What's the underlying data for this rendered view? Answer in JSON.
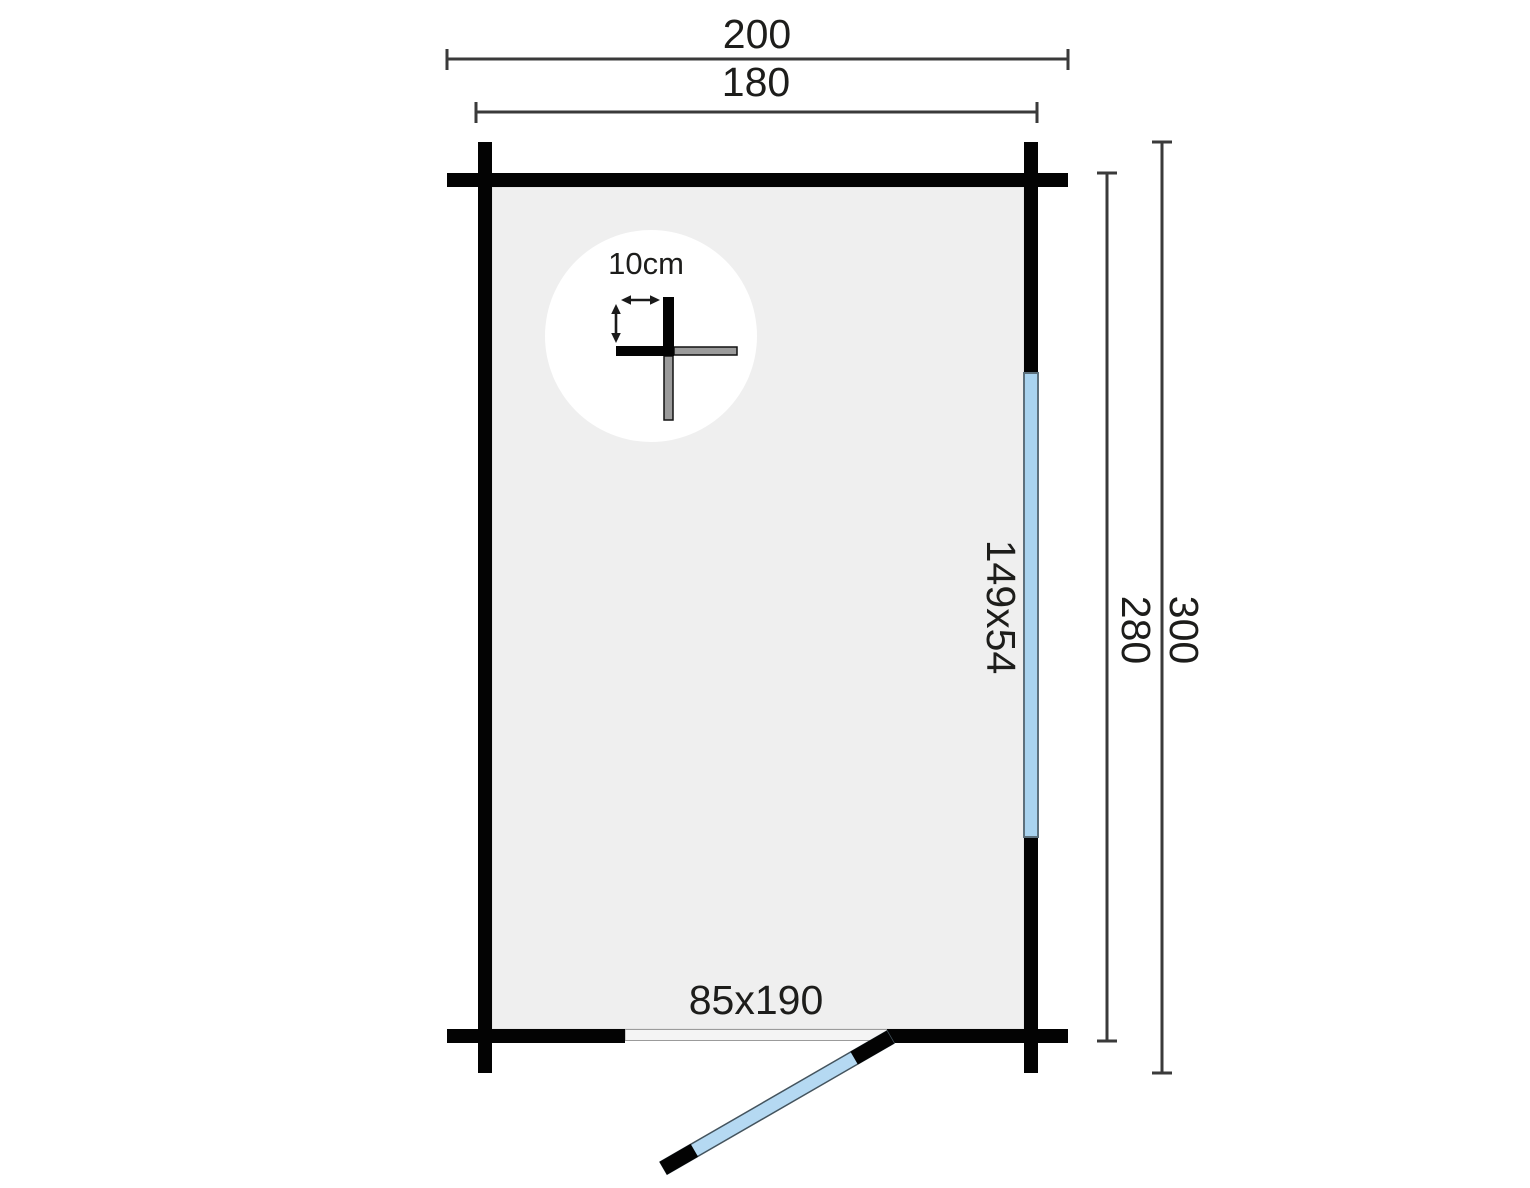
{
  "plan": {
    "type": "log-cabin-floor-plan",
    "dimensions": {
      "outer_width": "200",
      "wall_width": "180",
      "wall_height": "280",
      "outer_height": "300"
    },
    "window": {
      "size_label": "149x54"
    },
    "door": {
      "size_label": "85x190"
    },
    "wall_detail": {
      "thickness_label": "10cm"
    },
    "colors": {
      "wall": "#030303",
      "floor": "#efefef",
      "window_glass": "#a9d3ef",
      "door_panel": "#b5d9f2",
      "door_opening": "#f4f4f4",
      "detail_log_gray": "#9b9b9b",
      "detail_circle": "#ffffff",
      "dimension_line": "#3a3a3a",
      "label_text": "#1d1d1b"
    }
  }
}
